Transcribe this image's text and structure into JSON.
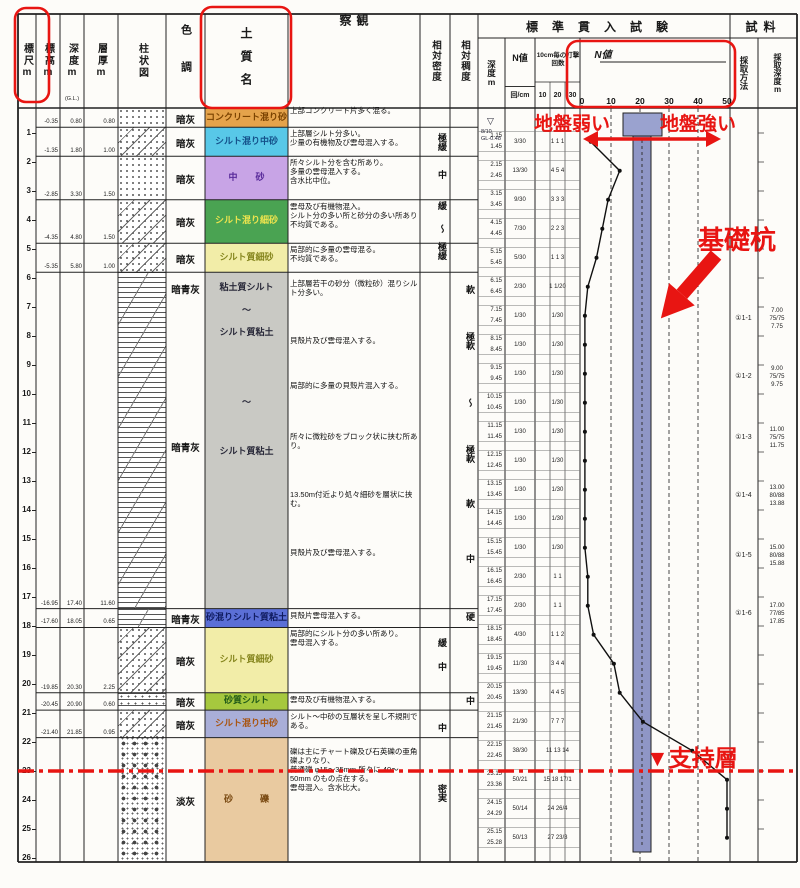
{
  "header": {
    "scale": "標尺m",
    "elev": "標高m",
    "depth": "深度m",
    "depth_sub": "(G.L.)",
    "thick": "層厚m",
    "column": "柱状図",
    "color": "色調",
    "soil": "土質名",
    "obs": "観察",
    "density": "相対密度",
    "consistency": "相対稠度",
    "spt_title": "標準貫入試験",
    "spt_depth": "深度m",
    "spt_n": "N値",
    "spt_n_unit": "回/cm",
    "spt_blows": "10cm毎の打撃回数",
    "spt_blow_cols": [
      "10",
      "20",
      "30"
    ],
    "spt_graph_label": "N値",
    "spt_scale": [
      "0",
      "10",
      "20",
      "30",
      "40",
      "50"
    ],
    "sample_title": "試料",
    "sample_method": "採取方法",
    "sample_depth": "採取深度m"
  },
  "water": {
    "mark": "▽",
    "date": "8/10",
    "level": "GL-0.48"
  },
  "layers": [
    {
      "top": 0.0,
      "bottom": 0.8,
      "color": "暗灰",
      "soil": "コンクリート混り砂",
      "bg": "#e5a34b",
      "fg": "#7a4200",
      "pattern": "sand",
      "elev": "-0.35",
      "dep": "0.80",
      "thick": "0.80",
      "obs": "上部コンクリート片多く混る。",
      "small": true
    },
    {
      "top": 0.8,
      "bottom": 1.8,
      "color": "暗灰",
      "soil": "シルト混り中砂",
      "bg": "#58c8e8",
      "fg": "#14508a",
      "pattern": "sand-silt",
      "elev": "-1.35",
      "dep": "1.80",
      "thick": "1.00",
      "obs": "上部層シルト分多い。\n少量の有機物及び雲母混入する。"
    },
    {
      "top": 1.8,
      "bottom": 3.3,
      "color": "暗灰",
      "soil": "中　　砂",
      "bg": "#c8a4e6",
      "fg": "#582a9a",
      "pattern": "sand",
      "elev": "-2.85",
      "dep": "3.30",
      "thick": "1.50",
      "obs": "所々シルト分を含む所あり。\n多量の雲母混入する。\n含水比中位。"
    },
    {
      "top": 3.3,
      "bottom": 4.8,
      "color": "暗灰",
      "soil": "シルト混り細砂",
      "bg": "#4aa352",
      "fg": "#eee44e",
      "pattern": "sand-silt",
      "elev": "-4.35",
      "dep": "4.80",
      "thick": "1.50",
      "obs": "雲母及び有機物混入。\nシルト分の多い所と砂分の多い所あり不均質である。"
    },
    {
      "top": 4.8,
      "bottom": 5.8,
      "color": "暗灰",
      "soil": "シルト質細砂",
      "bg": "#f2eda8",
      "fg": "#86861e",
      "pattern": "sand-silt",
      "elev": "-5.35",
      "dep": "5.80",
      "thick": "1.00",
      "obs": "局部的に多量の雲母混る。\n不均質である。"
    },
    {
      "top": 5.8,
      "bottom": 17.4,
      "color": "",
      "soil": "",
      "bg": "#c9c9c4",
      "fg": "#2a2a3a",
      "pattern": "silt",
      "elev": "-16.95",
      "dep": "17.40",
      "thick": "11.60",
      "color_labels": [
        {
          "d": 6.35,
          "t": "暗青灰"
        },
        {
          "d": 11.8,
          "t": "暗青灰"
        }
      ],
      "soil_labels": [
        {
          "d": 6.35,
          "t": "粘土質シルト"
        },
        {
          "d": 7.15,
          "t": "～"
        },
        {
          "d": 7.9,
          "t": "シルト質粘土"
        },
        {
          "d": 10.3,
          "t": "～"
        },
        {
          "d": 12.0,
          "t": "シルト質粘土"
        }
      ],
      "notes": [
        {
          "d": 6.05,
          "t": "上部層若干の砂分（微粒砂）混りシルト分多い。"
        },
        {
          "d": 8.0,
          "t": "貝殻片及び雲母混入する。"
        },
        {
          "d": 9.55,
          "t": "局部的に多量の貝殻片混入する。"
        },
        {
          "d": 11.3,
          "t": "所々に微粒砂をブロック状に挟む所あり。"
        },
        {
          "d": 13.3,
          "t": "13.50m付近より処々細砂を層状に挟む。"
        },
        {
          "d": 15.3,
          "t": "貝殻片及び雲母混入する。"
        }
      ]
    },
    {
      "top": 17.4,
      "bottom": 18.05,
      "color": "暗青灰",
      "soil": "砂混りシルト質粘土",
      "bg": "#5b6fd6",
      "fg": "#101c60",
      "pattern": "silt",
      "elev": "-17.60",
      "dep": "18.05",
      "thick": "0.65",
      "obs": "貝殻片雲母混入する。",
      "small": true
    },
    {
      "top": 18.05,
      "bottom": 20.3,
      "color": "暗灰",
      "soil": "シルト質細砂",
      "bg": "#f2eda8",
      "fg": "#86861e",
      "pattern": "sand-silt",
      "elev": "-19.85",
      "dep": "20.30",
      "thick": "2.25",
      "obs": "局部的にシルト分の多い所あり。\n雲母混入する。"
    },
    {
      "top": 20.3,
      "bottom": 20.9,
      "color": "暗灰",
      "soil": "砂質シルト",
      "bg": "#a6c83e",
      "fg": "#215a18",
      "pattern": "silt-sand",
      "elev": "-20.45",
      "dep": "20.90",
      "thick": "0.60",
      "obs": "雲母及び有機物混入する。",
      "small": true
    },
    {
      "top": 20.9,
      "bottom": 21.85,
      "color": "暗灰",
      "soil": "シルト混り中砂",
      "bg": "#a9aed8",
      "fg": "#a85410",
      "pattern": "sand-silt",
      "elev": "-21.40",
      "dep": "21.85",
      "thick": "0.95",
      "obs": "シルト～中砂の互層状を呈し不規則である。",
      "small": true
    },
    {
      "top": 21.85,
      "bottom": 26.14,
      "color": "淡灰",
      "soil": "砂　　　礫",
      "bg": "#e9caa0",
      "fg": "#7a4a12",
      "pattern": "gravel",
      "elev": "",
      "dep": "",
      "thick": "",
      "obs": "礫は主にチャート礫及び石英礫の亜角礫よりなり、\n普通礫 φ15～35mm 所々に 40～50mm のもの点在する。\n雲母混入。含水比大。",
      "obs_d": 22.1
    }
  ],
  "density_labels": [
    {
      "d": 1.35,
      "t": "極緩"
    },
    {
      "d": 2.45,
      "t": "中"
    },
    {
      "d": 3.5,
      "t": "緩"
    },
    {
      "d": 4.3,
      "t": "～"
    },
    {
      "d": 5.1,
      "t": "極緩"
    },
    {
      "d": 18.6,
      "t": "緩"
    },
    {
      "d": 19.4,
      "t": "中"
    },
    {
      "d": 21.5,
      "t": "中"
    },
    {
      "d": 23.8,
      "t": "密実"
    }
  ],
  "consistency_labels": [
    {
      "d": 6.4,
      "t": "軟"
    },
    {
      "d": 8.2,
      "t": "極軟"
    },
    {
      "d": 10.3,
      "t": "～"
    },
    {
      "d": 12.1,
      "t": "極軟"
    },
    {
      "d": 13.8,
      "t": "軟"
    },
    {
      "d": 15.7,
      "t": "中"
    },
    {
      "d": 17.7,
      "t": "硬"
    },
    {
      "d": 20.6,
      "t": "中"
    }
  ],
  "spt_rows": [
    {
      "d": 1.3,
      "dt": "1.15",
      "db": "1.45",
      "n": "3/30",
      "blows": "1 1 1",
      "N": 3
    },
    {
      "d": 2.3,
      "dt": "2.15",
      "db": "2.45",
      "n": "13/30",
      "blows": "4 5 4",
      "N": 13
    },
    {
      "d": 3.3,
      "dt": "3.15",
      "db": "3.45",
      "n": "9/30",
      "blows": "3 3 3",
      "N": 9
    },
    {
      "d": 4.3,
      "dt": "4.15",
      "db": "4.45",
      "n": "7/30",
      "blows": "2 2 3",
      "N": 7
    },
    {
      "d": 5.3,
      "dt": "5.15",
      "db": "5.45",
      "n": "5/30",
      "blows": "1 1 3",
      "N": 5
    },
    {
      "d": 6.3,
      "dt": "6.15",
      "db": "6.45",
      "n": "2/30",
      "blows": "1 1/20",
      "N": 2
    },
    {
      "d": 7.3,
      "dt": "7.15",
      "db": "7.45",
      "n": "1/30",
      "blows": "1/30",
      "N": 1
    },
    {
      "d": 8.3,
      "dt": "8.15",
      "db": "8.45",
      "n": "1/30",
      "blows": "1/30",
      "N": 1
    },
    {
      "d": 9.3,
      "dt": "9.15",
      "db": "9.45",
      "n": "1/30",
      "blows": "1/30",
      "N": 1
    },
    {
      "d": 10.3,
      "dt": "10.15",
      "db": "10.45",
      "n": "1/30",
      "blows": "1/30",
      "N": 1
    },
    {
      "d": 11.3,
      "dt": "11.15",
      "db": "11.45",
      "n": "1/30",
      "blows": "1/30",
      "N": 1
    },
    {
      "d": 12.3,
      "dt": "12.15",
      "db": "12.45",
      "n": "1/30",
      "blows": "1/30",
      "N": 1
    },
    {
      "d": 13.3,
      "dt": "13.15",
      "db": "13.45",
      "n": "1/30",
      "blows": "1/30",
      "N": 1
    },
    {
      "d": 14.3,
      "dt": "14.15",
      "db": "14.45",
      "n": "1/30",
      "blows": "1/30",
      "N": 1
    },
    {
      "d": 15.3,
      "dt": "15.15",
      "db": "15.45",
      "n": "1/30",
      "blows": "1/30",
      "N": 1
    },
    {
      "d": 16.3,
      "dt": "16.15",
      "db": "16.45",
      "n": "2/30",
      "blows": "1 1",
      "N": 2
    },
    {
      "d": 17.3,
      "dt": "17.15",
      "db": "17.45",
      "n": "2/30",
      "blows": "1 1",
      "N": 2
    },
    {
      "d": 18.3,
      "dt": "18.15",
      "db": "18.45",
      "n": "4/30",
      "blows": "1 1 2",
      "N": 4
    },
    {
      "d": 19.3,
      "dt": "19.15",
      "db": "19.45",
      "n": "11/30",
      "blows": "3 4 4",
      "N": 11
    },
    {
      "d": 20.3,
      "dt": "20.15",
      "db": "20.45",
      "n": "13/30",
      "blows": "4 4 5",
      "N": 13
    },
    {
      "d": 21.3,
      "dt": "21.15",
      "db": "21.45",
      "n": "21/30",
      "blows": "7 7 7",
      "N": 21
    },
    {
      "d": 22.3,
      "dt": "22.15",
      "db": "22.45",
      "n": "38/30",
      "blows": "11 13 14",
      "N": 38
    },
    {
      "d": 23.3,
      "dt": "23.15",
      "db": "23.36",
      "n": "50/21",
      "blows": "15 18 17/1",
      "N": 50
    },
    {
      "d": 24.3,
      "dt": "24.15",
      "db": "24.29",
      "n": "50/14",
      "blows": "24 26/4",
      "N": 50
    },
    {
      "d": 25.3,
      "dt": "25.15",
      "db": "25.28",
      "n": "50/13",
      "blows": "27 23/3",
      "N": 50
    }
  ],
  "samples": [
    {
      "label": "①1-1",
      "top": "7.00",
      "ratio": "75/75",
      "bot": "7.75",
      "d": 7.4
    },
    {
      "label": "①1-2",
      "top": "9.00",
      "ratio": "75/75",
      "bot": "9.75",
      "d": 9.4
    },
    {
      "label": "①1-3",
      "top": "11.00",
      "ratio": "75/75",
      "bot": "11.75",
      "d": 11.5
    },
    {
      "label": "①1-4",
      "top": "13.00",
      "ratio": "80/88",
      "bot": "13.88",
      "d": 13.5
    },
    {
      "label": "①1-5",
      "top": "15.00",
      "ratio": "80/88",
      "bot": "15.88",
      "d": 15.6
    },
    {
      "label": "①1-6",
      "top": "17.00",
      "ratio": "77/85",
      "bot": "17.85",
      "d": 17.6
    }
  ],
  "annotations": {
    "weak": "地盤弱い",
    "strong": "地盤強い",
    "pile": "基礎杭",
    "support": "▼支持層",
    "red": "#e81512",
    "pile_fill": "#8f96c6",
    "pile_cap_fill": "#9aa2cf"
  },
  "scale_max": 26
}
